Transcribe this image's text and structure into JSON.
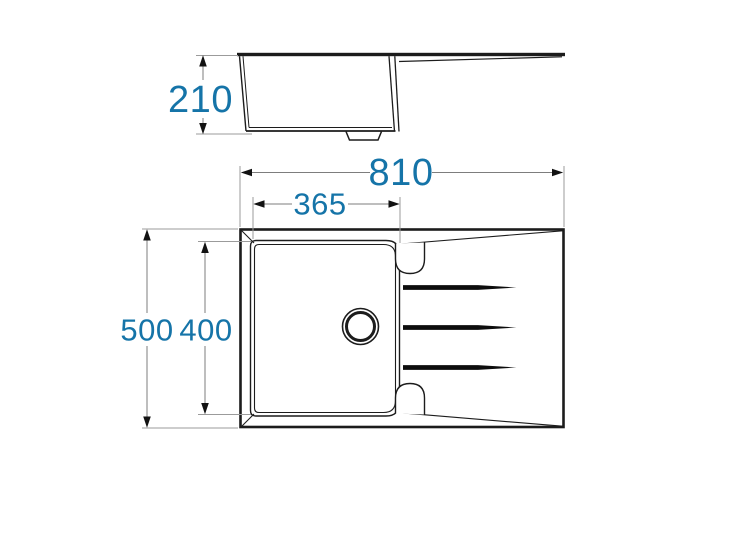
{
  "page": {
    "background_color": "#ffffff"
  },
  "drawing": {
    "accent_color": "#1574a8",
    "line_color": "#1c1c1c",
    "dimensions": {
      "side_height": "210",
      "overall_width": "810",
      "bowl_width": "365",
      "overall_depth": "500",
      "bowl_depth": "400"
    }
  }
}
